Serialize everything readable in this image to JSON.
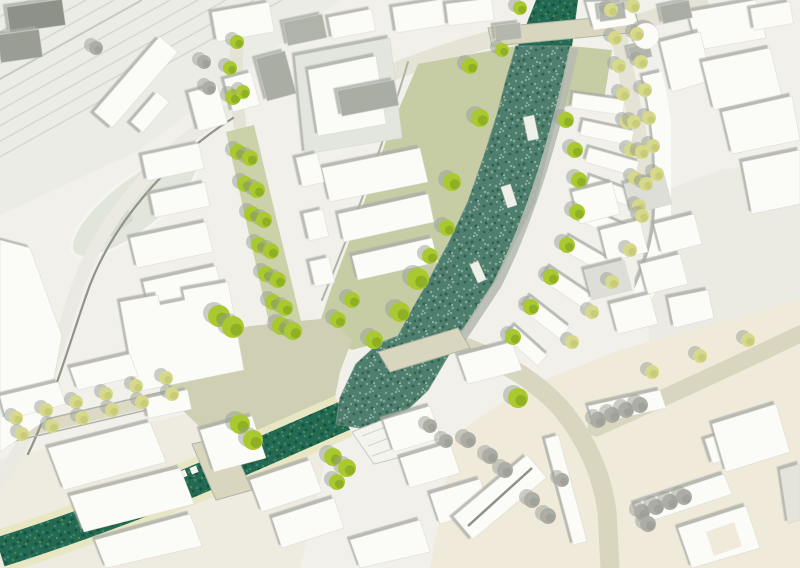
{
  "meta": {
    "kind": "urban-masterplan-site-plan",
    "width": 800,
    "height": 568,
    "visible_text": "none"
  },
  "palette": {
    "base": "#f1f0ea",
    "stationField": "#ecece6",
    "warmSE": "#efeada",
    "southTan": "#ebe8d7",
    "openEast": "#ebebe3",
    "rail": "#d7d7d1",
    "railDark": "#c9c9c3",
    "roadBeige": "#d8d6bf",
    "roadLight": "#e4e3d6",
    "roadPale": "#eaeae2",
    "roadWest": "#dcdac4",
    "curb": "#90948a",
    "curbSoft": "#b0b3a8",
    "sage": "#c6cda5",
    "greenStreet": "#cbd1a8",
    "plaza": "#cfcfb4",
    "riverFill": "#4e7e6e",
    "riverEdge": "#6b8f80",
    "canalFill": "#246a53",
    "bankPale": "#e9e6c3",
    "promenade": "#b7bbb1",
    "building": "#fbfbf7",
    "buildingStroke": "#d8d8d0",
    "roofGray": "#a9ada4",
    "roofMid": "#c6c8c1",
    "roofLight": "#dcded7",
    "darkBlock": "#8e9187",
    "deck": "#f4f4ee",
    "shadow": "#aaaea6",
    "treeBright": "#a9c92f",
    "treeBrightDark": "#84a51f",
    "treePale": "#d6d98b",
    "treePaleDark": "#c2c66e",
    "treeGray": "#adada5",
    "treeGrayDark": "#999d93",
    "treeShadow": "#9aa096"
  },
  "zones": [
    {
      "name": "station-field",
      "pts": "0,0 340,0 140,150 0,215",
      "fill": "stationField"
    },
    {
      "name": "open-east-plaza",
      "pts": "640,200 720,170 800,160 800,330 650,350",
      "fill": "openEast"
    },
    {
      "name": "warm-southeast",
      "pts": "430,568 455,435 520,390 620,350 800,300 800,568",
      "fill": "warmSE"
    },
    {
      "name": "south-tan",
      "pts": "0,460 210,408 330,440 300,568 0,568",
      "fill": "southTan",
      "opacity": 0.55
    }
  ],
  "rails": {
    "xs": [
      30,
      58,
      86,
      114,
      142,
      170,
      198,
      226,
      254,
      282
    ],
    "dx": -320,
    "dy": 178,
    "color": "rail",
    "width": 1.4,
    "accent": [
      1,
      4
    ],
    "accentColor": "railDark"
  },
  "roads": [
    {
      "name": "west-curved-road",
      "d": "M225,112 C160,152 100,220 76,292 C58,346 42,402 18,452 L0,482",
      "w": 13,
      "color": "roadPale"
    },
    {
      "name": "river-north-road",
      "d": "M330,98 Q420,58 488,40 L640,22 L700,4",
      "w": 17,
      "color": "roadLight"
    },
    {
      "name": "green-street-north-stub",
      "d": "M240,126 Q232,70 240,24",
      "w": 13,
      "color": "roadLight"
    },
    {
      "name": "west-street",
      "d": "M0,436 L205,388",
      "w": 13,
      "color": "roadWest"
    },
    {
      "name": "southeast-road",
      "d": "M468,348 Q530,372 564,412 Q600,458 607,512 L610,568",
      "w": 19,
      "color": "roadBeige"
    },
    {
      "name": "northeast-branch-road",
      "d": "M596,428 Q700,382 800,334",
      "w": 17,
      "color": "roadBeige"
    },
    {
      "name": "northeast-avenue",
      "d": "M612,2 L650,190",
      "w": 16,
      "color": "roadLight"
    },
    {
      "name": "avenue-south-curve",
      "d": "M650,190 Q662,240 644,288",
      "w": 11,
      "color": "roadLight"
    }
  ],
  "curbs": [
    {
      "d": "M233,118 C170,158 110,224 86,296 C68,348 52,404 28,454",
      "w": 2.2,
      "color": "curb"
    },
    {
      "d": "M408,62 C385,140 355,220 322,300",
      "w": 2,
      "color": "curbSoft"
    },
    {
      "d": "M228,133 L274,334",
      "w": 1.5,
      "color": "curbSoft"
    },
    {
      "d": "M253,126 L301,325",
      "w": 1.5,
      "color": "curbSoft"
    },
    {
      "d": "M0,430 L204,382",
      "w": 1.5,
      "color": "curbSoft"
    },
    {
      "d": "M2,444 L206,396",
      "w": 1.5,
      "color": "curbSoft"
    }
  ],
  "bands": [
    {
      "name": "riverbank-sage-strip",
      "pts": "516,46 498,112 468,202 428,282 396,338 352,350 316,334 330,292 362,208 390,130 418,64",
      "fill": "sage"
    },
    {
      "name": "east-bank-sage",
      "pts": "570,46 612,50 604,100 558,108",
      "fill": "sage"
    },
    {
      "name": "green-street",
      "pts": "226,132 254,125 302,326 272,336",
      "fill": "greenStreet"
    },
    {
      "name": "central-plaza",
      "pts": "170,345 250,326 330,318 352,340 340,372 332,412 310,448 205,432 168,396",
      "fill": "plaza"
    }
  ],
  "forecourt": {
    "cx": 135,
    "cy": 205,
    "rx": 78,
    "ry": 26,
    "rot": -38,
    "fill": "#e2e5da",
    "canopy": [
      118,
      222,
      30,
      16,
      -38,
      "#d6dacf"
    ]
  },
  "water": {
    "riverHead": "536,0 578,0 572,46 518,46",
    "river": "516,46 570,46 558,112 535,202 495,282 462,332 448,356 428,390 405,412 360,428 336,424 340,398 356,364 378,344 398,336 412,310 428,282 450,240 468,202 484,156 498,112 506,80",
    "canalCenterline": "M344,416 C260,452 150,505 0,552",
    "canalWidth": 30,
    "bankWidth": 44
  },
  "promenadePath": "M574,48 C560,115 537,205 497,285 L462,338",
  "bridges": [
    {
      "name": "north-road-bridge",
      "pts": "488,28 636,14 640,32 492,46"
    },
    {
      "name": "central-river-bridge",
      "pts": "378,352 458,328 470,348 390,372"
    },
    {
      "name": "canal-bridge",
      "pts": "192,444 228,436 252,490 216,500"
    }
  ],
  "deck": {
    "pts": "352,432 418,406 444,446 374,464",
    "steps": [
      "M362,436 L430,410",
      "M368,446 L436,420",
      "M372,456 L441,432"
    ]
  },
  "piers": [
    [
      531,
      128,
      11,
      24,
      -12
    ],
    [
      509,
      196,
      10,
      22,
      -18
    ],
    [
      478,
      272,
      9,
      20,
      -24
    ]
  ],
  "canalPiers": [
    [
      150,
      487
    ],
    [
      161,
      483
    ],
    [
      172,
      478
    ],
    [
      183,
      474
    ],
    [
      194,
      470
    ]
  ],
  "backBand": {
    "d": "M652,74 Q670,150 664,226 Q660,260 640,300",
    "w": 20,
    "color": "building"
  },
  "buildings": [
    {
      "rect": [
        136,
        82,
        100,
        24,
        -49
      ]
    },
    {
      "rect": [
        150,
        112,
        40,
        16,
        -49
      ]
    },
    {
      "rect": [
        36,
        16,
        56,
        26,
        -8
      ],
      "fill": "darkBlock"
    },
    {
      "rect": [
        20,
        46,
        42,
        28,
        -8
      ],
      "fill": "#9a9d93"
    },
    {
      "rect": [
        243,
        22,
        58,
        30,
        -10
      ]
    },
    {
      "rect": [
        305,
        30,
        40,
        24,
        -12
      ],
      "fill": "#b0b3aa"
    },
    {
      "rect": [
        276,
        76,
        30,
        44,
        -15
      ],
      "fill": "roofGray"
    },
    {
      "rect": [
        242,
        92,
        28,
        34,
        -15
      ]
    },
    {
      "rect": [
        208,
        108,
        30,
        40,
        -15
      ]
    },
    {
      "rect": [
        173,
        162,
        58,
        26,
        -12
      ]
    },
    {
      "rect": [
        180,
        200,
        56,
        24,
        -12
      ]
    },
    {
      "poly": "295,56 390,38 402,138 305,154",
      "fill": "#e3e5df"
    },
    {
      "poly": "308,70 376,56 386,124 318,136"
    },
    {
      "rect": [
        368,
        98,
        58,
        26,
        -11
      ],
      "fill": "roofGray"
    },
    {
      "rect": [
        352,
        24,
        44,
        22,
        -11
      ]
    },
    {
      "rect": [
        420,
        16,
        52,
        26,
        -9
      ]
    },
    {
      "rect": [
        470,
        12,
        46,
        22,
        -7
      ]
    },
    {
      "rect": [
        508,
        32,
        26,
        16,
        -7
      ],
      "fill": "#b4b7ae"
    },
    {
      "poly": "322,168 420,148 428,182 330,202"
    },
    {
      "poly": "338,214 428,194 434,222 344,242"
    },
    {
      "poly": "352,256 432,238 438,262 358,280"
    },
    {
      "rect": [
        310,
        170,
        22,
        30,
        -13
      ]
    },
    {
      "rect": [
        316,
        225,
        20,
        28,
        -13
      ]
    },
    {
      "rect": [
        322,
        272,
        20,
        26,
        -13
      ]
    },
    {
      "poly": "130,238 206,222 213,252 137,268"
    },
    {
      "poly": "143,282 216,266 223,294 150,310"
    },
    {
      "poly": "120,302 158,295 160,305 185,300 183,290 228,282 244,370 136,392"
    },
    {
      "rect": [
        108,
        372,
        30,
        18,
        -12
      ],
      "fill": "roofMid"
    },
    {
      "rect": [
        168,
        404,
        44,
        20,
        -12
      ]
    },
    {
      "poly": "0,240 30,248 62,336 46,420 0,452"
    },
    {
      "poly": "0,396 58,382 66,404 6,420"
    },
    {
      "poly": "70,368 130,354 138,376 78,390"
    },
    {
      "poly": "48,448 150,422 166,462 64,490"
    },
    {
      "poly": "70,496 180,468 194,504 84,532"
    },
    {
      "poly": "200,430 252,416 266,458 214,472"
    },
    {
      "poly": "95,540 190,514 202,546 106,568"
    },
    {
      "poly": "250,480 310,460 322,492 262,512"
    },
    {
      "poly": "272,518 334,498 344,528 282,548"
    },
    {
      "poly": "350,540 420,520 430,552 360,568"
    },
    {
      "poly": "383,420 430,406 441,438 394,452"
    },
    {
      "poly": "400,458 450,443 460,473 410,488"
    },
    {
      "poly": "430,494 480,479 490,509 440,524"
    },
    {
      "poly": "458,356 512,342 522,370 468,384"
    },
    {
      "rect": [
        598,
        104,
        52,
        15,
        8
      ]
    },
    {
      "rect": [
        607,
        133,
        52,
        15,
        12
      ]
    },
    {
      "rect": [
        612,
        162,
        52,
        15,
        16
      ]
    },
    {
      "rect": [
        612,
        192,
        52,
        15,
        20
      ]
    },
    {
      "rect": [
        604,
        224,
        52,
        15,
        25
      ]
    },
    {
      "rect": [
        588,
        256,
        52,
        15,
        30
      ]
    },
    {
      "rect": [
        567,
        288,
        52,
        15,
        34
      ]
    },
    {
      "rect": [
        545,
        318,
        50,
        15,
        38
      ]
    },
    {
      "rect": [
        526,
        346,
        44,
        14,
        42
      ]
    },
    {
      "poly": "572,192 612,182 620,214 580,224"
    },
    {
      "poly": "624,184 664,174 672,204 632,214",
      "fill": "roofLight"
    },
    {
      "poly": "600,230 640,220 648,252 608,262"
    },
    {
      "poly": "654,224 694,214 702,244 662,254"
    },
    {
      "poly": "584,270 624,260 632,290 592,300",
      "fill": "roofLight"
    },
    {
      "poly": "640,264 680,254 688,284 648,294"
    },
    {
      "poly": "610,304 650,294 658,324 618,334"
    },
    {
      "poly": "668,298 708,290 714,318 674,328"
    },
    {
      "poly": "688,12 756,0 766,38 698,50"
    },
    {
      "poly": "660,42 700,32 712,80 672,92"
    },
    {
      "poly": "702,62 770,48 782,96 714,110"
    },
    {
      "poly": "722,112 792,96 800,140 732,154"
    },
    {
      "rect": [
        676,
        12,
        30,
        18,
        -12
      ],
      "fill": "roofGray"
    },
    {
      "rect": [
        772,
        16,
        40,
        22,
        -10
      ]
    },
    {
      "poly": "742,162 800,150 800,204 752,214"
    },
    {
      "rect": [
        640,
        52,
        22,
        14,
        -12
      ],
      "fill": "#b2b5ac"
    },
    {
      "poly": "586,2 630,0 638,24 594,30"
    },
    {
      "rect": [
        612,
        12,
        26,
        16,
        -8
      ],
      "fill": "#b3b6ad"
    },
    {
      "rect": [
        500,
        497,
        96,
        30,
        -40
      ]
    },
    {
      "rect": [
        566,
        490,
        14,
        110,
        -15
      ]
    },
    {
      "poly": "588,406 660,390 666,408 594,424"
    },
    {
      "poly": "634,504 724,474 732,494 642,524"
    },
    {
      "rect": [
        744,
        440,
        74,
        26,
        -18
      ]
    },
    {
      "poly": "678,528 746,506 760,548 692,568"
    },
    {
      "poly": "712,424 776,404 790,452 726,472"
    },
    {
      "poly": "780,470 800,464 800,520 788,524",
      "fill": "#e4e4dc"
    }
  ],
  "circleBuilding": {
    "cx": 646,
    "cy": 36,
    "r": 13
  },
  "lines": [
    {
      "name": "gable-ridge",
      "d": "M468,526 L532,468",
      "w": 2.5,
      "color": "darkBlock"
    },
    {
      "name": "courtyard-hole",
      "poly": "706,532 734,522 742,546 714,556",
      "fill": "warmSE"
    }
  ],
  "trees": {
    "bright": [
      [
        238,
        152,
        8
      ],
      [
        250,
        158,
        8
      ],
      [
        245,
        184,
        8
      ],
      [
        257,
        190,
        8
      ],
      [
        252,
        214,
        8
      ],
      [
        264,
        220,
        8
      ],
      [
        259,
        245,
        8
      ],
      [
        271,
        251,
        8
      ],
      [
        266,
        274,
        8
      ],
      [
        278,
        280,
        8
      ],
      [
        273,
        302,
        8
      ],
      [
        285,
        308,
        8
      ],
      [
        281,
        326,
        9
      ],
      [
        293,
        331,
        9
      ],
      [
        233,
        97,
        8
      ],
      [
        243,
        92,
        7
      ],
      [
        230,
        68,
        7
      ],
      [
        237,
        42,
        7
      ],
      [
        219,
        316,
        11
      ],
      [
        233,
        327,
        11
      ],
      [
        240,
        424,
        10
      ],
      [
        253,
        440,
        10
      ],
      [
        333,
        457,
        9
      ],
      [
        347,
        468,
        9
      ],
      [
        337,
        482,
        8
      ],
      [
        470,
        66,
        8
      ],
      [
        480,
        118,
        9
      ],
      [
        452,
        182,
        9
      ],
      [
        447,
        228,
        8
      ],
      [
        430,
        256,
        8
      ],
      [
        418,
        279,
        11
      ],
      [
        400,
        312,
        10
      ],
      [
        374,
        340,
        9
      ],
      [
        352,
        300,
        8
      ],
      [
        338,
        320,
        8
      ],
      [
        566,
        120,
        8
      ],
      [
        575,
        150,
        8
      ],
      [
        579,
        180,
        8
      ],
      [
        577,
        212,
        8
      ],
      [
        567,
        245,
        8
      ],
      [
        551,
        277,
        8
      ],
      [
        531,
        307,
        8
      ],
      [
        513,
        337,
        8
      ],
      [
        518,
        398,
        10
      ],
      [
        520,
        8,
        7
      ],
      [
        502,
        50,
        7
      ]
    ],
    "pale": [
      [
        611,
        10,
        7
      ],
      [
        615,
        38,
        7
      ],
      [
        619,
        66,
        7
      ],
      [
        623,
        94,
        7
      ],
      [
        627,
        122,
        7
      ],
      [
        631,
        150,
        7
      ],
      [
        635,
        178,
        7
      ],
      [
        639,
        206,
        7
      ],
      [
        633,
        6,
        7
      ],
      [
        637,
        34,
        7
      ],
      [
        641,
        62,
        7
      ],
      [
        645,
        90,
        7
      ],
      [
        649,
        118,
        7
      ],
      [
        653,
        146,
        7
      ],
      [
        657,
        174,
        7
      ],
      [
        634,
        122,
        7
      ],
      [
        642,
        152,
        7
      ],
      [
        646,
        184,
        7
      ],
      [
        642,
        216,
        7
      ],
      [
        630,
        250,
        7
      ],
      [
        612,
        282,
        7
      ],
      [
        592,
        312,
        7
      ],
      [
        572,
        342,
        7
      ],
      [
        16,
        418,
        7
      ],
      [
        46,
        410,
        7
      ],
      [
        76,
        402,
        7
      ],
      [
        106,
        394,
        7
      ],
      [
        136,
        386,
        7
      ],
      [
        166,
        378,
        7
      ],
      [
        22,
        434,
        7
      ],
      [
        52,
        426,
        7
      ],
      [
        82,
        418,
        7
      ],
      [
        112,
        410,
        7
      ],
      [
        142,
        402,
        7
      ],
      [
        172,
        394,
        7
      ],
      [
        652,
        372,
        7
      ],
      [
        700,
        356,
        7
      ],
      [
        748,
        340,
        7
      ]
    ],
    "gray": [
      [
        598,
        420,
        8
      ],
      [
        612,
        415,
        8
      ],
      [
        626,
        410,
        8
      ],
      [
        640,
        405,
        8
      ],
      [
        642,
        512,
        8
      ],
      [
        656,
        507,
        8
      ],
      [
        670,
        502,
        8
      ],
      [
        684,
        497,
        8
      ],
      [
        648,
        524,
        8
      ],
      [
        490,
        456,
        8
      ],
      [
        505,
        470,
        8
      ],
      [
        468,
        440,
        8
      ],
      [
        430,
        426,
        7
      ],
      [
        446,
        441,
        7
      ],
      [
        532,
        500,
        8
      ],
      [
        548,
        516,
        8
      ],
      [
        562,
        480,
        7
      ],
      [
        204,
        62,
        7
      ],
      [
        209,
        88,
        7
      ],
      [
        96,
        48,
        7
      ]
    ]
  }
}
